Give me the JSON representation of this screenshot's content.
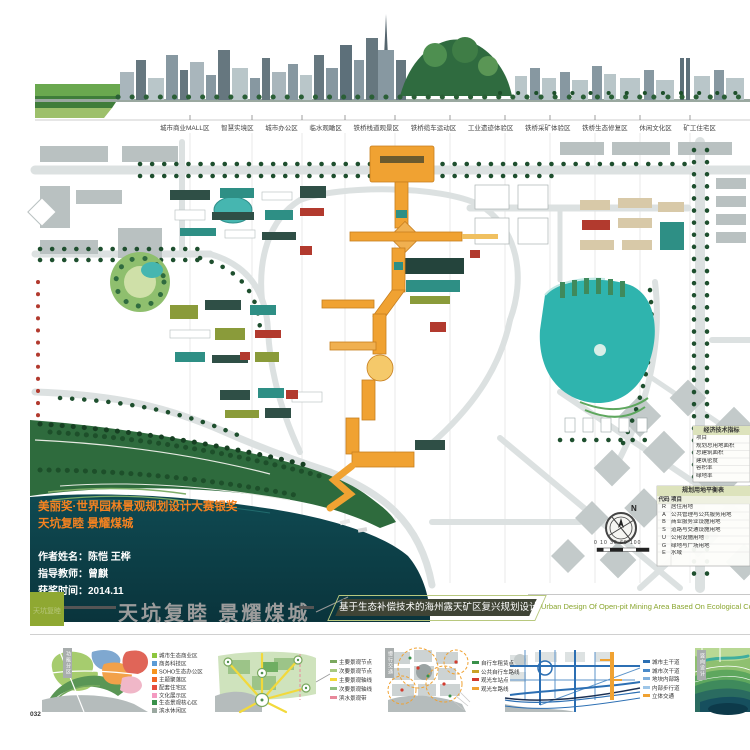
{
  "page_number": "032",
  "skyline": {
    "zone_labels": [
      "城市商业MALL区",
      "智慧实境区",
      "城市办公区",
      "临水观瞰区",
      "铁桥栈道观景区",
      "铁桥缆车运动区",
      "工业遗迹体验区",
      "铁桥采矿体验区",
      "铁桥生态修复区",
      "休闲文化区",
      "矿工住宅区"
    ]
  },
  "award": {
    "line1": "美丽奖·世界园林景观规划设计大赛银奖",
    "line2": "天坑复睦 景耀煤城",
    "author": "作者姓名：陈恺 王桦",
    "advisor": "指导教师：曾麒",
    "date": "获奖时间：2014.11"
  },
  "titlebar": {
    "logo_text": "天坑复睦",
    "title": "天坑复睦 景耀煤城",
    "subtitle_cn": "基于生态补偿技术的海州露天矿区复兴规划设计",
    "subtitle_en": "Urban Design Of Open-pit Mining Area Based On Ecological Compensation Te"
  },
  "map": {
    "compass": "N",
    "scalebar": "0 10 30  60    100",
    "econ_table": {
      "title": "经济技术指标",
      "rows": [
        "项目",
        "规划总用地面积",
        "总建筑面积",
        "建筑密度",
        "容积率",
        "绿地率"
      ]
    },
    "landuse_table": {
      "title": "规划用地平衡表",
      "headers": [
        "代码",
        "项目"
      ],
      "rows": [
        {
          "code": "R",
          "name": "居住用地"
        },
        {
          "code": "A",
          "name": "公共管理与公共服务用地"
        },
        {
          "code": "B",
          "name": "商业服务业设施用地"
        },
        {
          "code": "S",
          "name": "道路与交通设施用地"
        },
        {
          "code": "U",
          "name": "公用设施用地"
        },
        {
          "code": "G",
          "name": "绿地与广场用地"
        },
        {
          "code": "E",
          "name": "水域"
        }
      ]
    }
  },
  "bottom_panels": [
    {
      "tag": "功能分区",
      "legend": [
        {
          "label": "城市生态商业区",
          "color": "#8dc63f"
        },
        {
          "label": "商务科技区",
          "color": "#5b9bd5"
        },
        {
          "label": "SOHO生态办公区",
          "color": "#f7941d"
        },
        {
          "label": "主题聚落区",
          "color": "#f26522"
        },
        {
          "label": "配套住宅区",
          "color": "#e64c3c"
        },
        {
          "label": "文化展示区",
          "color": "#f49ac1"
        },
        {
          "label": "生态景观核心区",
          "color": "#39914a"
        },
        {
          "label": "滨水休闲区",
          "color": "#9aa8a0"
        }
      ]
    },
    {
      "legend": [
        {
          "label": "主要景观节点",
          "color": "#7aa85e"
        },
        {
          "label": "次要景观节点",
          "color": "#a8c97f"
        },
        {
          "label": "主要景观轴线",
          "color": "#f2d93b"
        },
        {
          "label": "次要景观轴线",
          "color": "#8fbf7a"
        },
        {
          "label": "滨水景观带",
          "color": "#e8889a"
        }
      ]
    },
    {
      "tag": "慢行交通",
      "legend": [
        {
          "label": "自行车租赁点",
          "color": "#39914a"
        },
        {
          "label": "公共自行车路线",
          "color": "#c9a227"
        },
        {
          "label": "观光车站点",
          "color": "#d23b2e"
        },
        {
          "label": "观光车路线",
          "color": "#f0a232"
        }
      ]
    },
    {
      "legend": [
        {
          "label": "城市主干道",
          "color": "#2c6fb3"
        },
        {
          "label": "城市次干道",
          "color": "#4a8ac9"
        },
        {
          "label": "地块内部路",
          "color": "#7fb0dd"
        },
        {
          "label": "内部步行道",
          "color": "#9ec6e8"
        },
        {
          "label": "立体交通",
          "color": "#f0a232"
        }
      ]
    },
    {
      "tag": "竖向设计",
      "legend": []
    }
  ],
  "colors": {
    "award_orange": "#f58220",
    "spine_orange": "#f0a232",
    "lake_teal": "#2fb4ae",
    "pit_water": "#0e4a52",
    "olive_green": "#8aa62f",
    "title_gray": "#9c9c9c"
  }
}
